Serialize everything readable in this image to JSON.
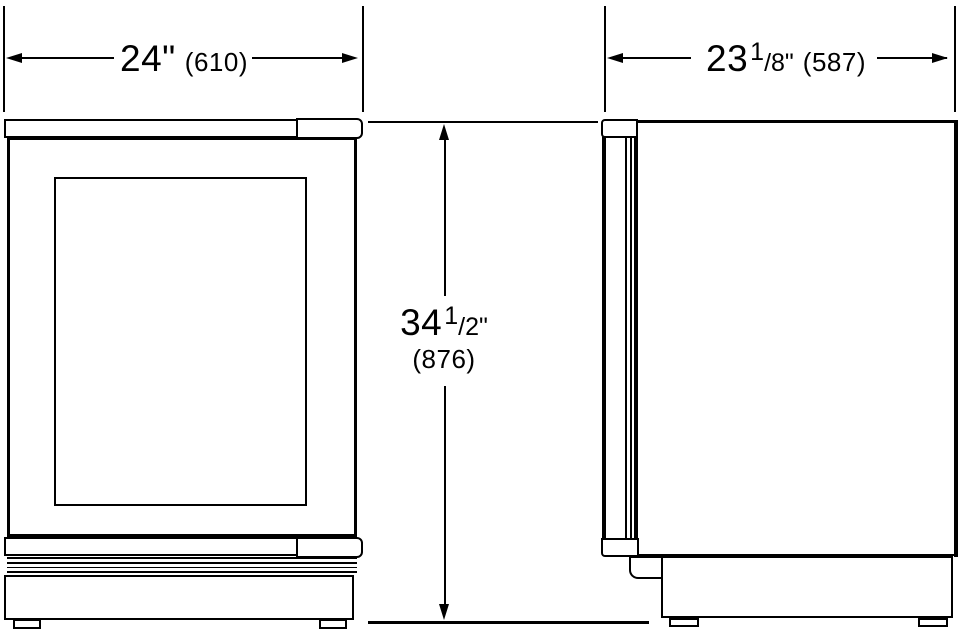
{
  "colors": {
    "background": "#ffffff",
    "line": "#000000"
  },
  "dimensions": {
    "width": {
      "imperial": "24\"",
      "metric": "(610)"
    },
    "depth": {
      "whole": "23",
      "numerator": "1",
      "fraction": "/8\"",
      "metric": "(587)"
    },
    "height": {
      "whole": "34",
      "numerator": "1",
      "fraction": "/2\"",
      "metric": "(876)"
    }
  }
}
